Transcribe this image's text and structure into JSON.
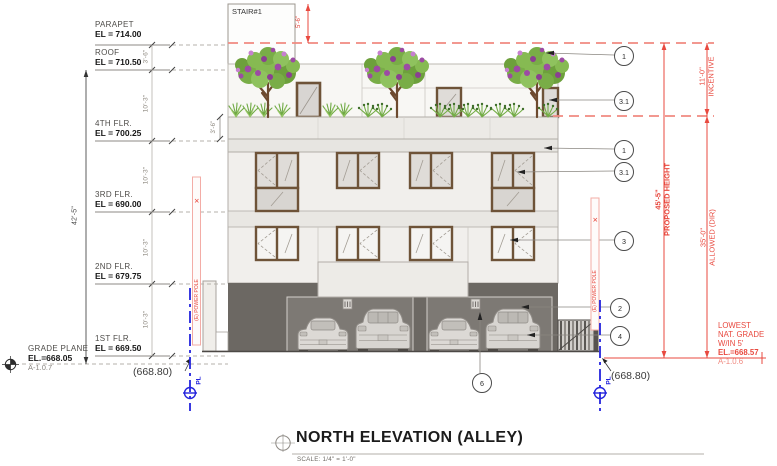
{
  "title_block": {
    "title": "NORTH ELEVATION (ALLEY)",
    "scale": "SCALE: 1/4\" = 1'-0\""
  },
  "levels": [
    {
      "name": "PARAPET",
      "el": "EL = 714.00"
    },
    {
      "name": "ROOF",
      "el": "EL = 710.50"
    },
    {
      "name": "4TH FLR.",
      "el": "EL = 700.25"
    },
    {
      "name": "3RD FLR.",
      "el": "EL = 690.00"
    },
    {
      "name": "2ND FLR.",
      "el": "EL = 679.75"
    },
    {
      "name": "1ST FLR.",
      "el": "EL = 669.50"
    }
  ],
  "grade_plane": {
    "name": "GRADE PLANE",
    "el": "EL.=668.05",
    "ref": "A-1.0.7"
  },
  "dims": {
    "overall_left": "42'-5\"",
    "parapet_roof": "3'-6\"",
    "floor": "10'-3\"",
    "planter": "3'-6\"",
    "stair": "5'-6\"",
    "incentive_dim": "11'-0\"",
    "incentive_label": "INCENTIVE",
    "proposed_dim": "45'-5\"",
    "proposed_label": "PROPOSED HEIGHT",
    "allowed_dim": "35'-0\"",
    "allowed_label": "ALLOWED (DIR)"
  },
  "stair": {
    "label": "STAIR#1"
  },
  "lowest_grade": {
    "line1": "LOWEST",
    "line2": "NAT. GRADE",
    "line3": "W/IN 5'",
    "el": "EL.=668.57",
    "ref": "A-1.0.6"
  },
  "spot_elevations": {
    "left": "(668.80)",
    "right": "(668.80)"
  },
  "property_line": {
    "label": "PL"
  },
  "power_pole": {
    "label": "(E) POWER POLE"
  },
  "callouts": [
    {
      "num": "1"
    },
    {
      "num": "3.1"
    },
    {
      "num": "1"
    },
    {
      "num": "3.1"
    },
    {
      "num": "3"
    },
    {
      "num": "2"
    },
    {
      "num": "4"
    },
    {
      "num": "6"
    }
  ],
  "colors": {
    "annotation_red": "#e8493f",
    "property_line_blue": "#2424dd",
    "wall_light": "#f1efec",
    "garage_dark": "#6c6863",
    "window_frame_brown": "#6e5338",
    "tree_green": "#7ab348",
    "tree_purple": "#9c4ba4"
  }
}
